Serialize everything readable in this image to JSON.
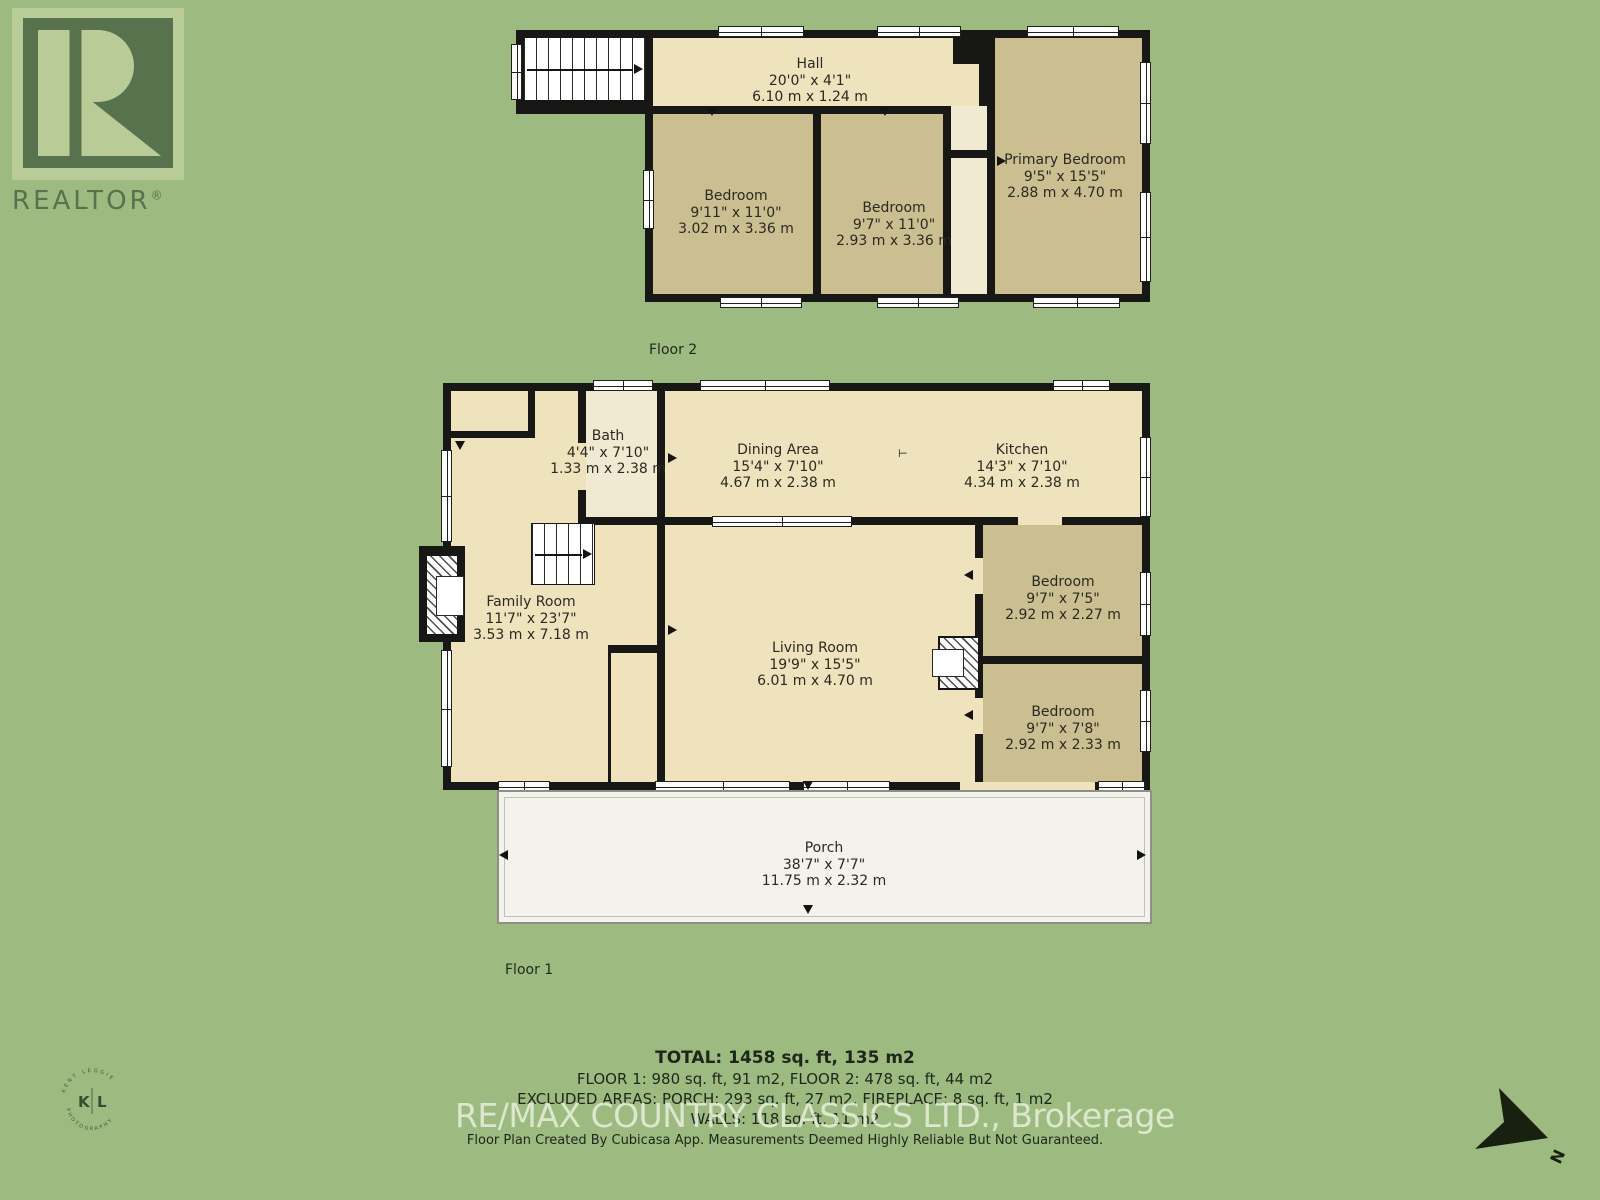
{
  "branding": {
    "realtor_word": "REALTOR",
    "registered_mark": "®",
    "watermark": "RE/MAX COUNTRY CLASSICS LTD., Brokerage",
    "disclaimer": "Floor Plan Created By Cubicasa App. Measurements Deemed Highly Reliable But Not Guaranteed.",
    "badge": {
      "left_initial": "K",
      "right_initial": "L",
      "arc_top": "KENT LEGGIE",
      "arc_bottom": "PHOTOGRAPHY"
    }
  },
  "compass": {
    "north_label": "N"
  },
  "floor2": {
    "label": "Floor 2",
    "rooms": [
      {
        "name": "Hall",
        "imperial": "20'0\" x 4'1\"",
        "metric": "6.10 m x 1.24 m"
      },
      {
        "name": "Bedroom",
        "imperial": "9'11\" x 11'0\"",
        "metric": "3.02 m x 3.36 m"
      },
      {
        "name": "Bedroom",
        "imperial": "9'7\" x 11'0\"",
        "metric": "2.93 m x 3.36 m"
      },
      {
        "name": "Primary Bedroom",
        "imperial": "9'5\" x 15'5\"",
        "metric": "2.88 m x 4.70 m"
      }
    ]
  },
  "floor1": {
    "label": "Floor 1",
    "rooms": [
      {
        "name": "Bath",
        "imperial": "4'4\" x 7'10\"",
        "metric": "1.33 m x 2.38 m"
      },
      {
        "name": "Dining Area",
        "imperial": "15'4\" x 7'10\"",
        "metric": "4.67 m x 2.38 m"
      },
      {
        "name": "Kitchen",
        "imperial": "14'3\" x 7'10\"",
        "metric": "4.34 m x 2.38 m"
      },
      {
        "name": "Family Room",
        "imperial": "11'7\" x 23'7\"",
        "metric": "3.53 m x 7.18 m"
      },
      {
        "name": "Living Room",
        "imperial": "19'9\" x 15'5\"",
        "metric": "6.01 m x 4.70 m"
      },
      {
        "name": "Bedroom",
        "imperial": "9'7\" x 7'5\"",
        "metric": "2.92 m x 2.27 m"
      },
      {
        "name": "Bedroom",
        "imperial": "9'7\" x 7'8\"",
        "metric": "2.92 m x 2.33 m"
      },
      {
        "name": "Porch",
        "imperial": "38'7\" x 7'7\"",
        "metric": "11.75 m x 2.32 m"
      }
    ]
  },
  "summary": {
    "total": "TOTAL: 1458 sq. ft, 135 m2",
    "floors": "FLOOR 1: 980 sq. ft, 91 m2, FLOOR 2: 478 sq. ft, 44 m2",
    "excluded": "EXCLUDED AREAS: PORCH: 293 sq. ft, 27 m2, FIREPLACE: 8 sq. ft, 1 m2",
    "walls": "WALLS: 118 sq. ft, 11 m2"
  },
  "colors": {
    "background": "#9dbb80",
    "wall": "#171715",
    "room_cream": "#eee3bd",
    "room_tan": "#cbbe90",
    "porch": "#f4f2ec",
    "logo_green": "#57724c",
    "logo_light": "#b9cc98"
  }
}
